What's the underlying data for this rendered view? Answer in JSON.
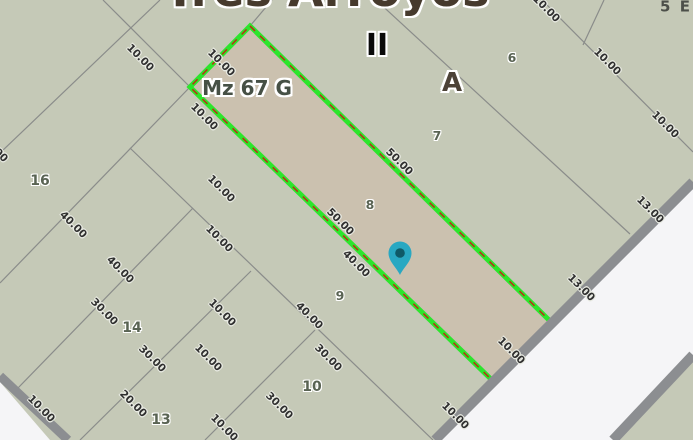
{
  "map": {
    "title": "Tres Arroyos",
    "block_label": "Mz 67 G",
    "zones": {
      "roman": "II",
      "section": "A",
      "corner": "5 E"
    },
    "parcels": [
      "16",
      "14",
      "13",
      "10",
      "9",
      "8",
      "7",
      "6"
    ],
    "dims": [
      "10.00",
      "10.00",
      "10.00",
      "10.00",
      "10.00",
      "40.00",
      "10.00",
      "40.00",
      "30.00",
      "10.00",
      "30.00",
      "10.00",
      "20.00",
      "10.00",
      "10.00",
      "30.00",
      "50.00",
      "40.00",
      "40.00",
      "30.00",
      "50.00",
      "10.00",
      "10.00",
      "10.00",
      "10.00",
      "10.00",
      "13.00",
      "13.00"
    ],
    "marker": "location-pin",
    "colors": {
      "parcel_fill": "#c5c9b7",
      "highlight_fill": "#cbc1af",
      "highlight_border": "#2ce52c",
      "highlight_dash": "#b43614",
      "boundary_gray": "#8a8c8a",
      "road_gray": "#8c8e91",
      "street": "#f5f5f7",
      "pin_fill": "#29a8c2",
      "pin_dot": "#0f5a67"
    }
  }
}
